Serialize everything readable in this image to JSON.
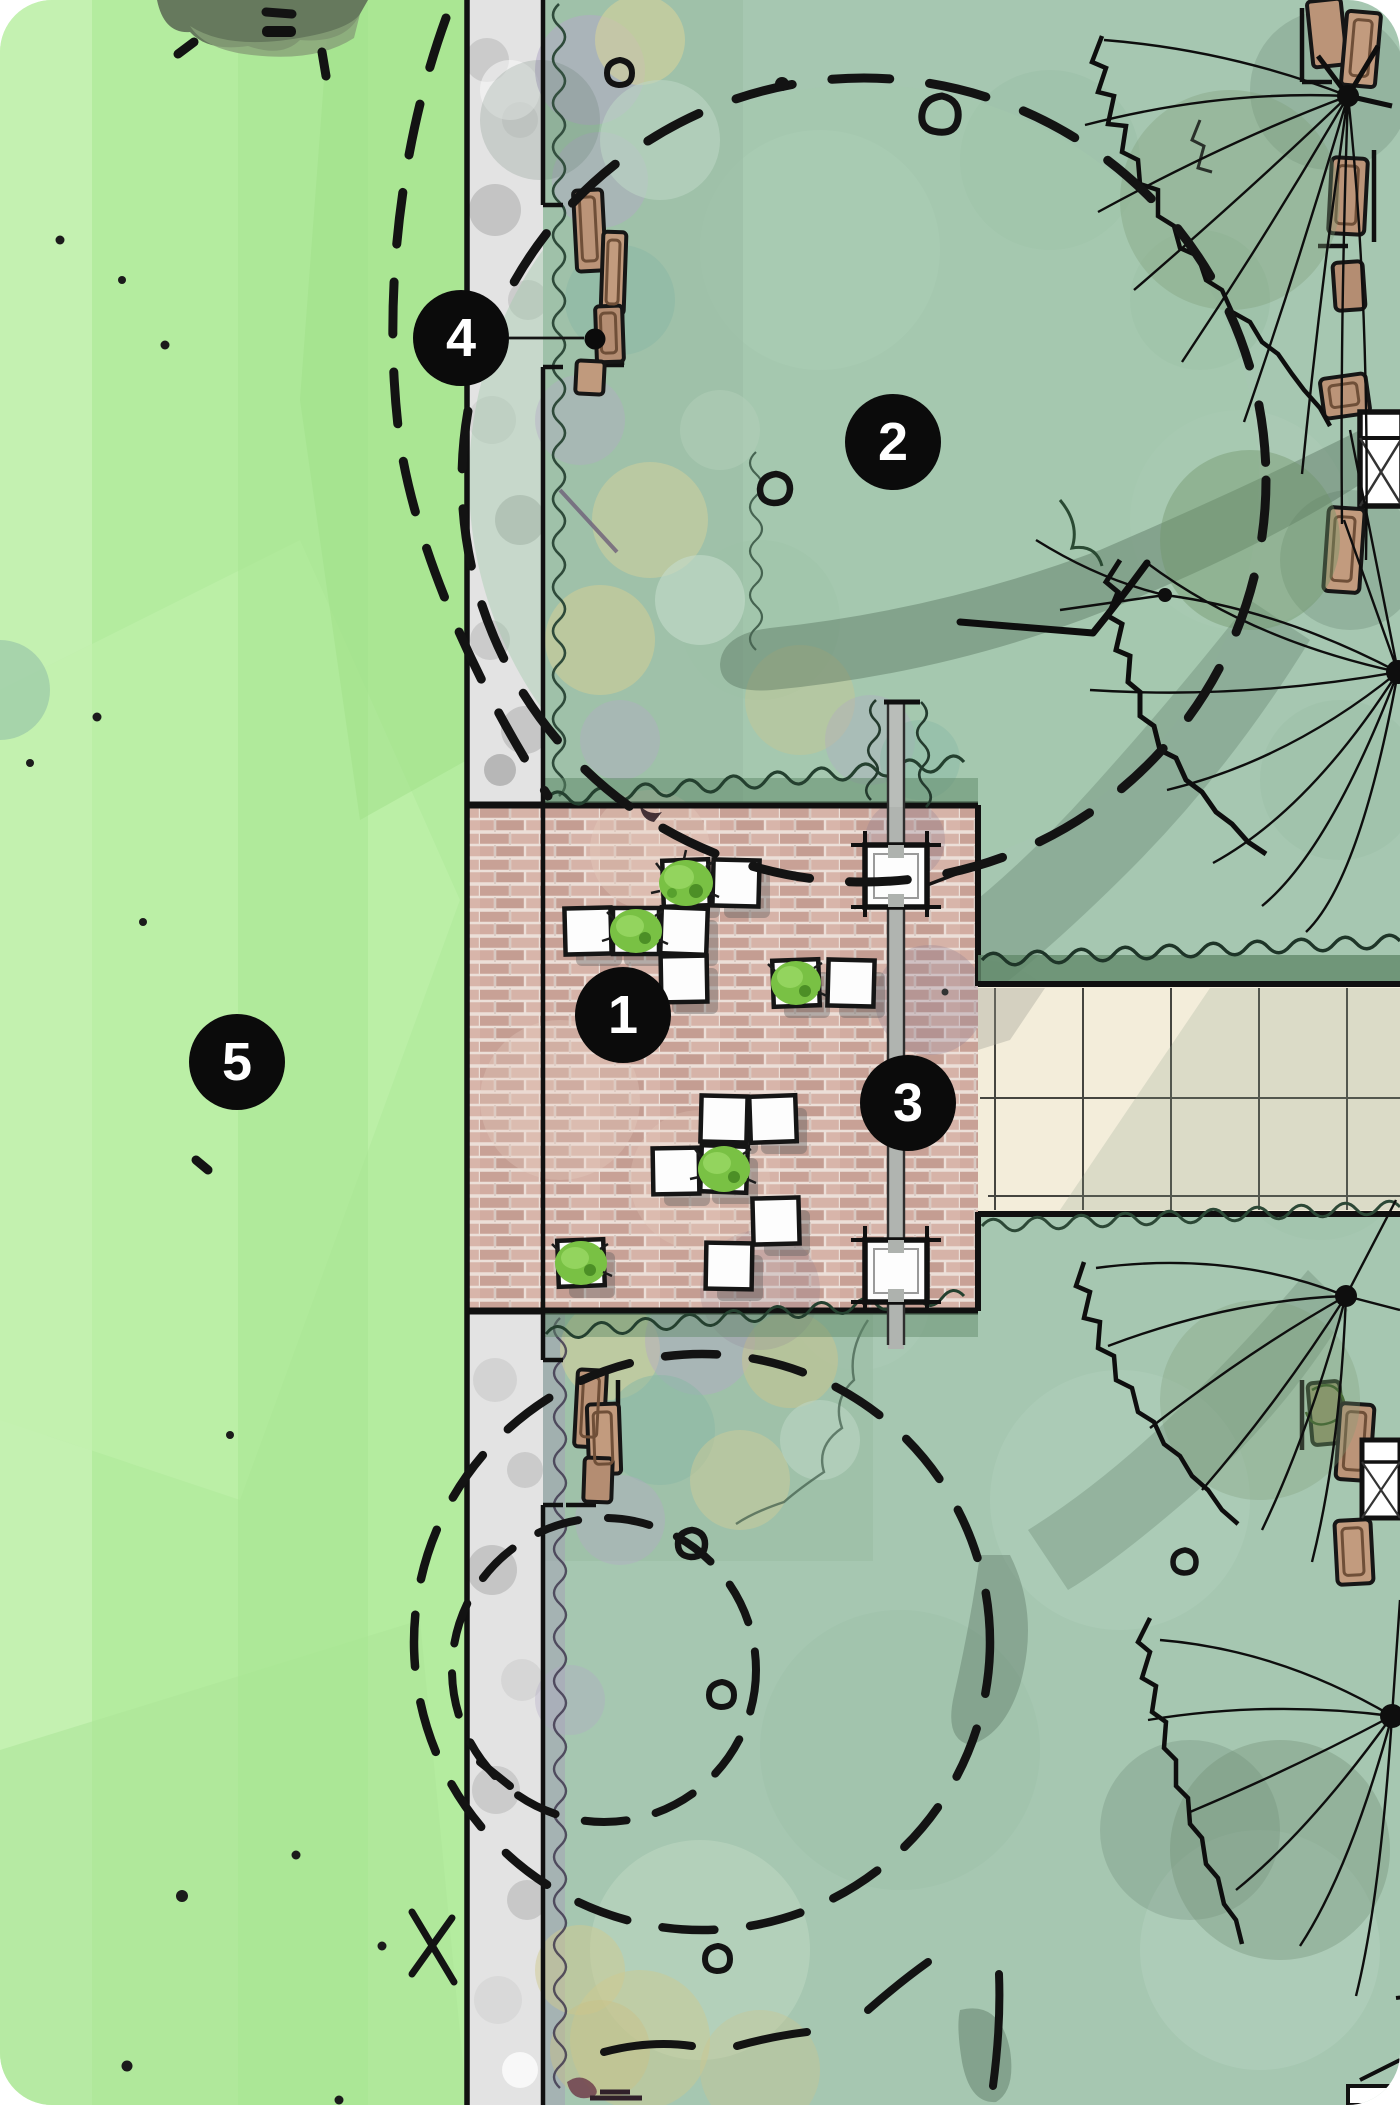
{
  "plan": {
    "canvas": {
      "width": 1400,
      "height": 2105
    },
    "markers": [
      {
        "label": "1",
        "cx": 623,
        "cy": 1015
      },
      {
        "label": "2",
        "cx": 893,
        "cy": 442
      },
      {
        "label": "3",
        "cx": 908,
        "cy": 1103
      },
      {
        "label": "4",
        "cx": 461,
        "cy": 338
      },
      {
        "label": "5",
        "cx": 237,
        "cy": 1062
      }
    ],
    "palette": {
      "marker_bg": "#0b0b0b",
      "marker_fg": "#ffffff",
      "lawn": "#b4ec9f",
      "lawn_light": "#cdf4bb",
      "sidewalk": "#e3e3e3",
      "sage": "#a6c7b1",
      "bed_purple": "#b3a9c6",
      "bed_yellow": "#d6d29b",
      "bed_teal": "#8ab8a6",
      "hedge": "#5d8767",
      "brick_base": "#cfaba0",
      "brick_mortar": "#ecdfd8",
      "path_tan": "#f3edda",
      "bench_wood": "#bb9478",
      "bush_green": "#79c144",
      "ink": "#141414",
      "shadow": "#4f6b58"
    }
  }
}
